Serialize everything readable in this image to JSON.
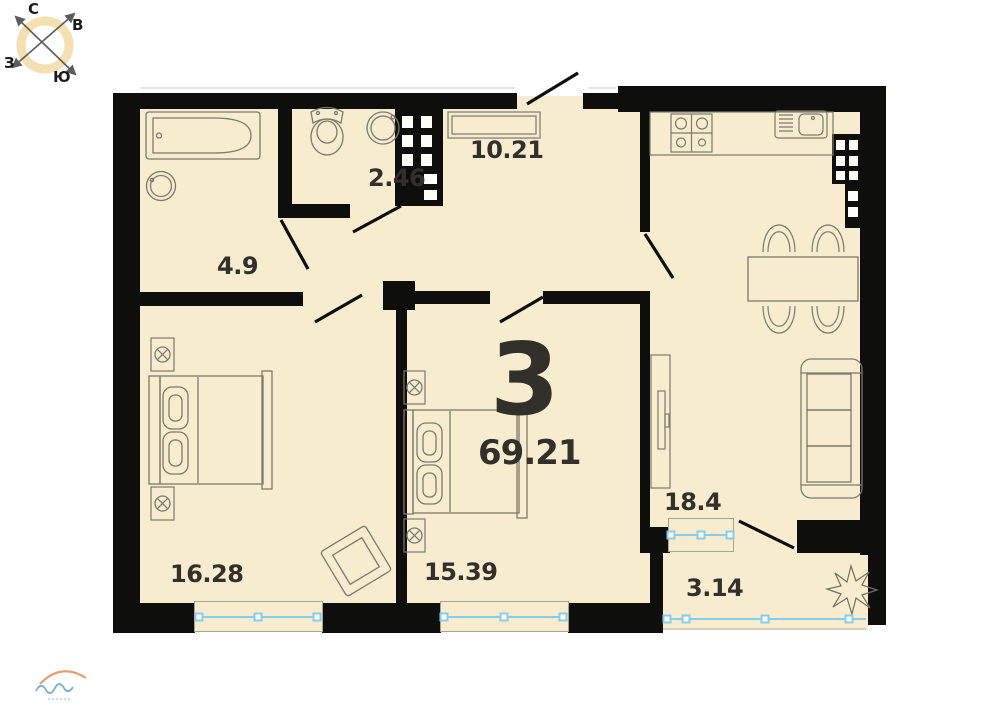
{
  "plan": {
    "rooms_count": "3",
    "total_area": "69.21",
    "rooms": [
      {
        "name": "hallway",
        "area": "10.21"
      },
      {
        "name": "toilet",
        "area": "2.46"
      },
      {
        "name": "bathroom",
        "area": "4.9"
      },
      {
        "name": "bedroom-1",
        "area": "16.28"
      },
      {
        "name": "bedroom-2",
        "area": "15.39"
      },
      {
        "name": "kitchen-living-room",
        "area": "18.4"
      },
      {
        "name": "balcony",
        "area": "3.14"
      }
    ]
  },
  "compass": {
    "north": "С",
    "east": "В",
    "south": "Ю",
    "west": "З"
  },
  "icons": [
    "bathtub-icon",
    "washing-machine-icon",
    "toilet-icon",
    "sink-icon",
    "wardrobe-icon",
    "stove-icon",
    "kitchen-sink-icon",
    "vent-shaft",
    "dining-table-icon",
    "chair-icon",
    "sofa-icon",
    "tv-stand-icon",
    "bed-icon",
    "nightstand-icon",
    "armchair-icon",
    "plant-icon",
    "window-symbol",
    "door-swing",
    "compass-rose",
    "watermark-logo"
  ],
  "colors": {
    "room_fill": "#f8eccf",
    "wall": "#0e0e0c",
    "label_text": "#32302b",
    "window_blue": "#86cdec",
    "compass_ring": "#f5e0b2",
    "logo_orange": "#e2854e",
    "logo_blue": "#5a9dc8"
  }
}
